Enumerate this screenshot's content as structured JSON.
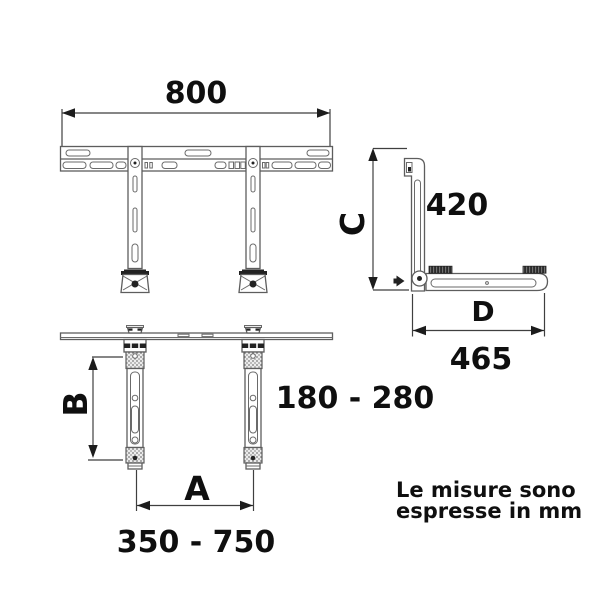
{
  "diagram": {
    "labels": {
      "dim_800": "800",
      "dim_420": "420",
      "letter_c": "C",
      "letter_d": "D",
      "dim_465": "465",
      "range_wall": "180 - 280",
      "letter_b": "B",
      "letter_a": "A",
      "range_arms": "350 - 750",
      "note_line1": "Le misure sono",
      "note_line2": "espresse in mm"
    },
    "colors": {
      "background": "#ffffff",
      "outline": "#5d5d5d",
      "dimension_line": "#3f3f3f",
      "dark_detail": "#222222",
      "text": "#0f0f0f"
    }
  }
}
